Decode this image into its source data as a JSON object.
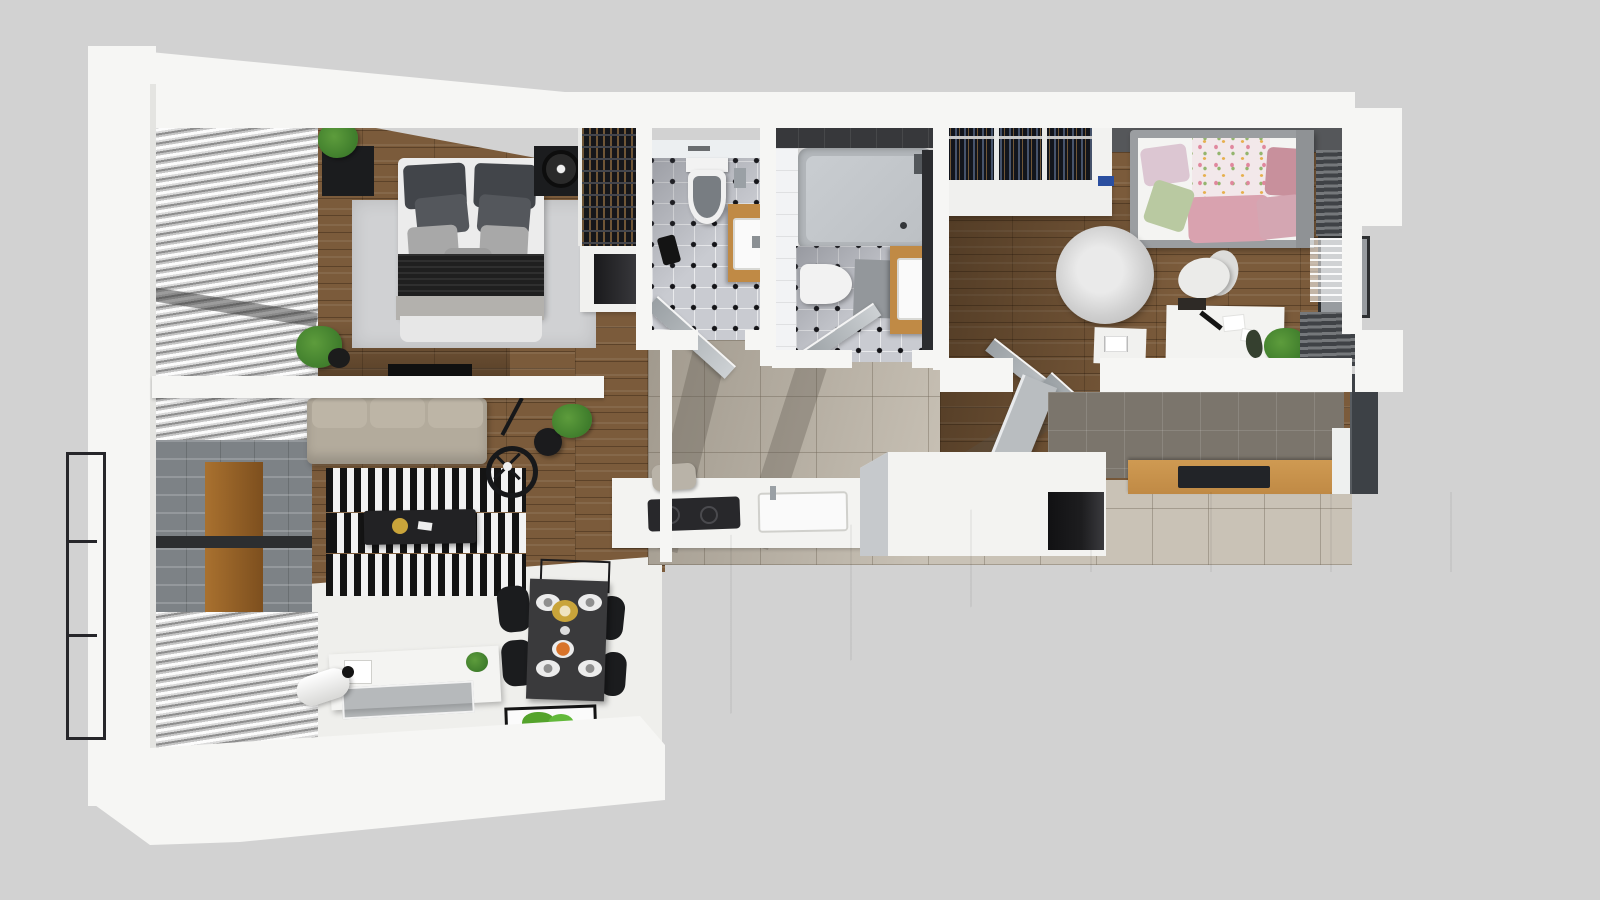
{
  "scene": {
    "type": "3d-floorplan-cutaway-render",
    "rooms": [
      "master-bedroom",
      "living-room",
      "wc-bathroom",
      "main-bathroom",
      "hallway",
      "kitchen",
      "kids-room",
      "wardrobe",
      "balcony-railing"
    ],
    "furniture": [
      "double-bed",
      "nightstands",
      "wardrobe-rails",
      "striped-rug",
      "sofa",
      "coffee-table",
      "wheel-clock",
      "wall-lamp",
      "tv-sideboard",
      "floor-lamp",
      "moss-art",
      "dining-table",
      "dining-chairs",
      "wine-rack",
      "toilet",
      "vanity-sink",
      "bathtub",
      "kids-bed",
      "round-rug",
      "desk",
      "desk-chair",
      "kitchen-counter",
      "island",
      "fridge"
    ]
  },
  "palette": {
    "bg": "#d2d2d2",
    "wall": "#f6f6f4",
    "wallShade": "#e4e4e1",
    "wood": "#7b5b3b",
    "woodDark": "#4a3722",
    "whiteFloor": "#efefec",
    "tileBeige": "#c9c2b6",
    "taupe": "#7b756c",
    "bathTile": "#c9cbd1",
    "bathDot": "#141418",
    "tub": "#b4b8bc",
    "tubInner": "#c9cdd1",
    "darkWall": "#37383b",
    "vanity": "#c08a45",
    "sink": "#fafafa",
    "fixtureGray": "#9aa0a5",
    "blindLight": "#fcfcfc",
    "blindDark": "#8e8e8e",
    "blindDarker": "#3f4246",
    "glass": "#7d8286",
    "brick": "#9a9a98",
    "doorWood": "#a9712f",
    "railing": "#26262a",
    "sofa": "#b3ab9c",
    "rugLight": "#d0d1d3",
    "stripeBlack": "#141414",
    "stripeWhite": "#f2f2f2",
    "furnitureBlack": "#1b1c1e",
    "tableDark": "#3a3a3c",
    "plate": "#ececec",
    "gold": "#c9a43a",
    "food": "#d8732a",
    "plant": "#3f7d2c",
    "moss": "#54a32b",
    "duvet": "#f2e8ea",
    "pillowPink": "#d4a6b2",
    "pillowGreen": "#b9c9a1",
    "pillowRose": "#c8909c",
    "pillowLilac": "#dcc6d2",
    "bedFrame": "#9b9ea1",
    "kidsWall": "#55575a",
    "fluffRug": "#cfcfcf",
    "desk": "#f3f3f1",
    "closetBase": "#141820",
    "closetSlatA": "#46536b",
    "closetSlatB": "#705636",
    "fridge": "#3d4146",
    "counter": "#f3f3f1",
    "cooktop": "#28282b",
    "niche": "#1d1d1f"
  }
}
